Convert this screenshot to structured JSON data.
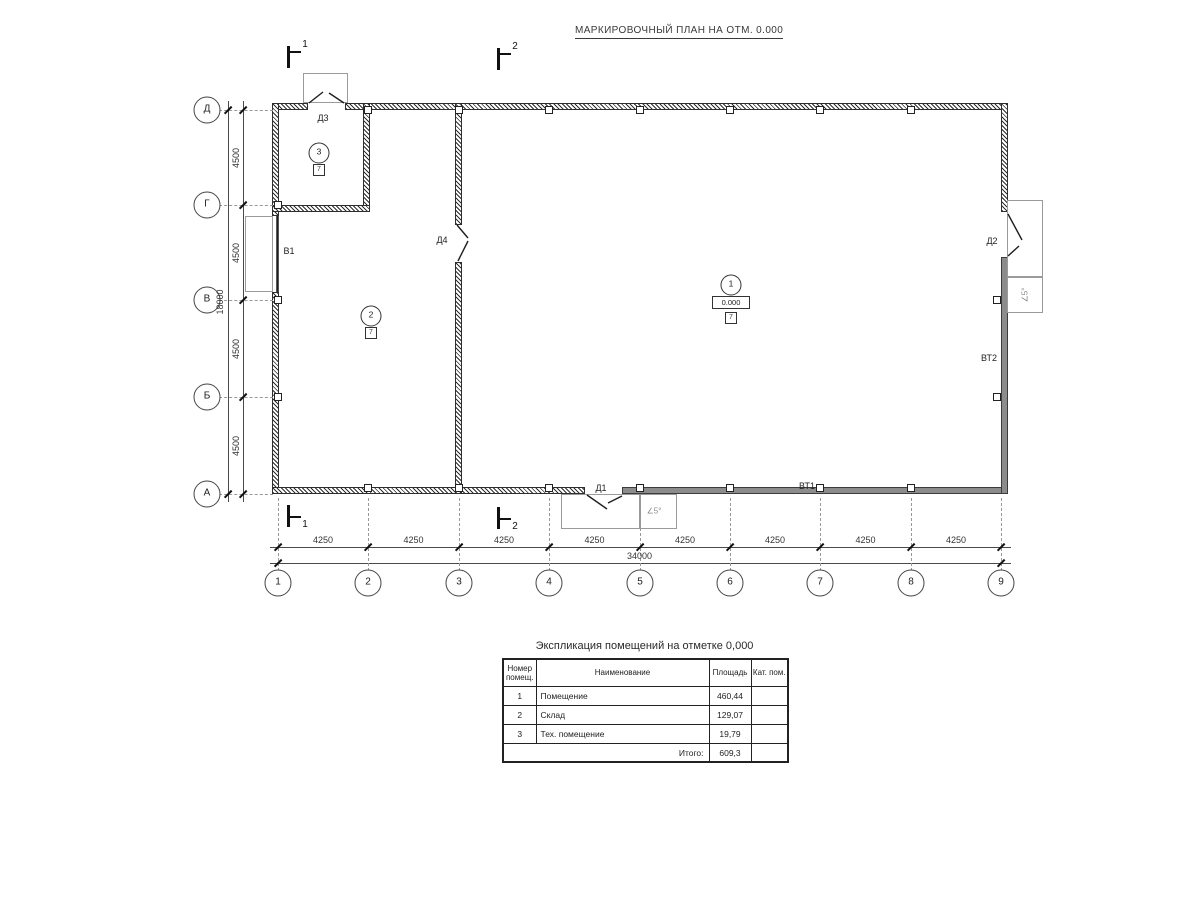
{
  "title": "МАРКИРОВОЧНЫЙ ПЛАН НА ОТМ. 0.000",
  "plan": {
    "axes_x": [
      {
        "label": "1",
        "x": 278
      },
      {
        "label": "2",
        "x": 368
      },
      {
        "label": "3",
        "x": 459
      },
      {
        "label": "4",
        "x": 549
      },
      {
        "label": "5",
        "x": 640
      },
      {
        "label": "6",
        "x": 730
      },
      {
        "label": "7",
        "x": 820
      },
      {
        "label": "8",
        "x": 911
      },
      {
        "label": "9",
        "x": 1001
      }
    ],
    "axes_y": [
      {
        "label": "Д",
        "y": 110
      },
      {
        "label": "Г",
        "y": 205
      },
      {
        "label": "В",
        "y": 300
      },
      {
        "label": "Б",
        "y": 397
      },
      {
        "label": "А",
        "y": 494
      }
    ],
    "dim_bottom_segments": [
      "4250",
      "4250",
      "4250",
      "4250",
      "4250",
      "4250",
      "4250",
      "4250"
    ],
    "dim_bottom_total": "34000",
    "dim_left_segments": [
      "4500",
      "4500",
      "4500",
      "4500"
    ],
    "dim_left_total": "18000",
    "sections": [
      {
        "label": "1",
        "x": 287,
        "y": 46,
        "below": false
      },
      {
        "label": "2",
        "x": 497,
        "y": 48,
        "below": false
      },
      {
        "label": "1",
        "x": 287,
        "y": 505,
        "below": true
      },
      {
        "label": "2",
        "x": 497,
        "y": 507,
        "below": true
      }
    ],
    "labels": [
      {
        "name": "door-label-d3",
        "text": "Д3",
        "x": 323,
        "y": 118
      },
      {
        "name": "door-label-d4",
        "text": "Д4",
        "x": 442,
        "y": 240
      },
      {
        "name": "door-label-d1",
        "text": "Д1",
        "x": 601,
        "y": 488
      },
      {
        "name": "door-label-d2",
        "text": "Д2",
        "x": 992,
        "y": 241
      },
      {
        "name": "gate-label-v1",
        "text": "В1",
        "x": 289,
        "y": 251
      },
      {
        "name": "gate-label-vt1",
        "text": "ВТ1",
        "x": 807,
        "y": 486
      },
      {
        "name": "gate-label-vt2",
        "text": "ВТ2",
        "x": 989,
        "y": 358
      },
      {
        "name": "slope-label-bottom",
        "text": "∠5°",
        "x": 654,
        "y": 511,
        "rot": 0,
        "muted": true
      },
      {
        "name": "slope-label-right",
        "text": "∠5°",
        "x": 1025,
        "y": 295,
        "rot": -90,
        "muted": true
      }
    ],
    "rooms": [
      {
        "number": "1",
        "elevation": "0.000",
        "category": "7",
        "cx": 731,
        "cy": 285
      },
      {
        "number": "2",
        "category": "7",
        "cx": 371,
        "cy": 316
      },
      {
        "number": "3",
        "category": "7",
        "cx": 319,
        "cy": 153
      }
    ]
  },
  "schedule": {
    "title": "Экспликация помещений на отметке 0,000",
    "headers": [
      "Номер помещ.",
      "Наименование",
      "Площадь",
      "Кат. пом."
    ],
    "col_widths": [
      33,
      173,
      42,
      37
    ],
    "rows": [
      {
        "num": "1",
        "name": "Помещение",
        "area": "460,44",
        "cat": ""
      },
      {
        "num": "2",
        "name": "Склад",
        "area": "129,07",
        "cat": ""
      },
      {
        "num": "3",
        "name": "Тех. помещение",
        "area": "19,79",
        "cat": ""
      }
    ],
    "total_label": "Итого:",
    "total_value": "609,3"
  }
}
